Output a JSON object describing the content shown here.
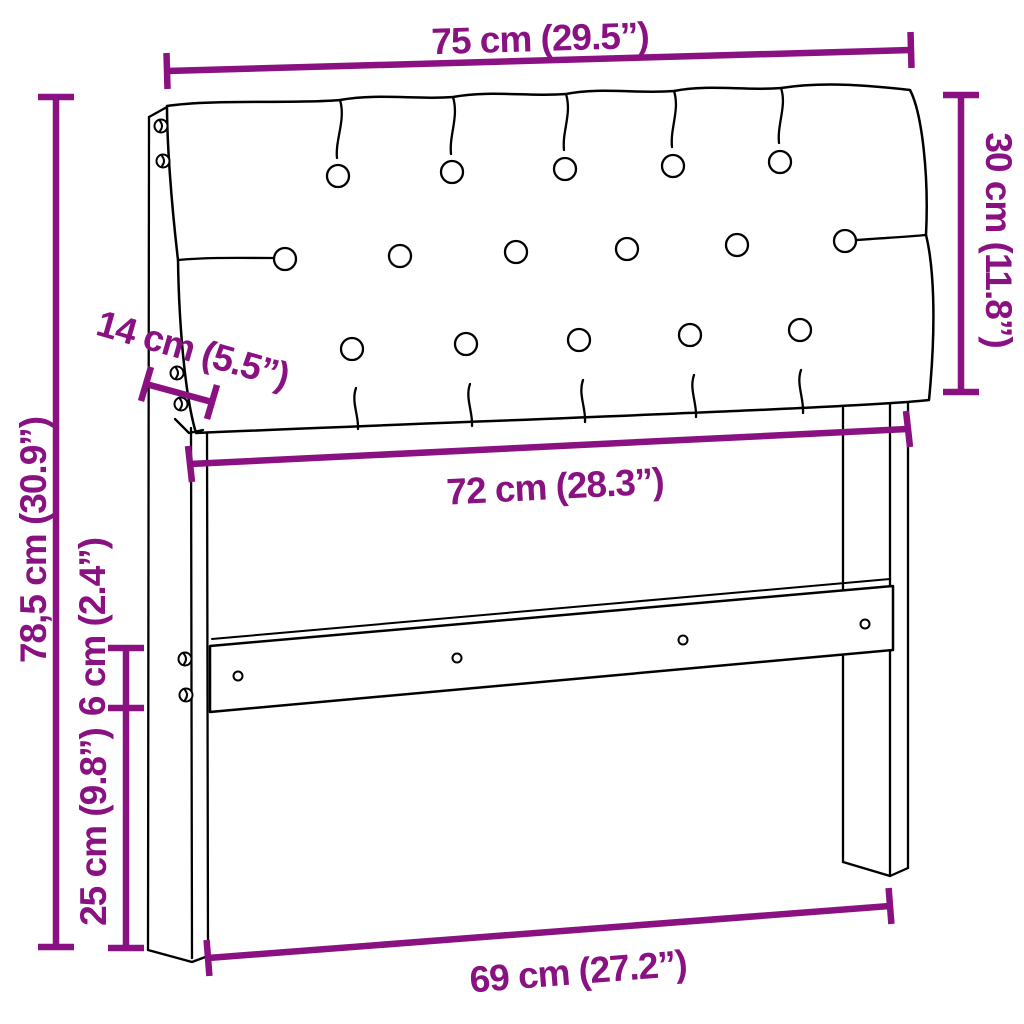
{
  "image": {
    "type": "product-dimension-diagram",
    "subject": "headboard with upholstered tufted cushion",
    "background": "#ffffff"
  },
  "colors": {
    "dim-color": "#8A1181",
    "line-color": "#000000"
  },
  "dimensions": {
    "width_top": {
      "label": "75 cm (29.5”)"
    },
    "cushion_height": {
      "label": "30 cm (11.8”)"
    },
    "depth": {
      "label": "14 cm (5.5”)"
    },
    "height_total": {
      "label": "78,5 cm (30.9”)"
    },
    "width_inner": {
      "label": "72 cm (28.3”)"
    },
    "rail_height": {
      "label": "6 cm (2.4”)"
    },
    "height_lower": {
      "label": "25 cm (9.8”)"
    },
    "width_bottom": {
      "label": "69 cm (27.2”)"
    }
  }
}
